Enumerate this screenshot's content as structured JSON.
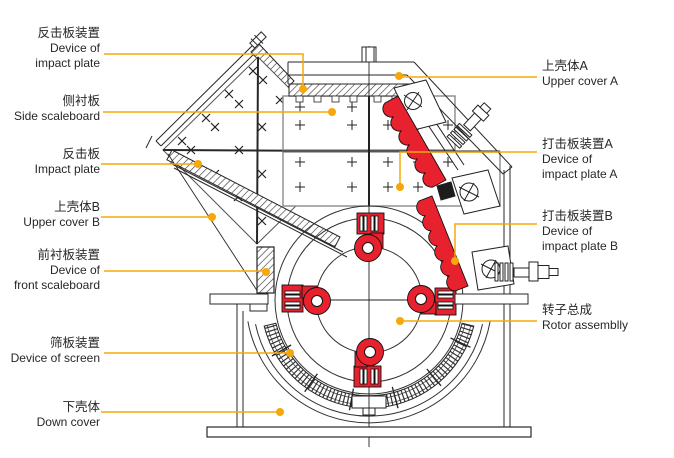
{
  "figure": {
    "kind": "impact-crusher sectional diagram",
    "colors": {
      "accent_leader": "#f6a80a",
      "part_red": "#e8212e",
      "line_ink": "#2a2626"
    }
  },
  "labels_left": [
    {
      "zh": "反击板装置",
      "en_lines": [
        "Device of",
        "impact plate"
      ]
    },
    {
      "zh": "侧衬板",
      "en_lines": [
        "Side scaleboard"
      ]
    },
    {
      "zh": "反击板",
      "en_lines": [
        "Impact plate"
      ]
    },
    {
      "zh": "上壳体B",
      "en_lines": [
        "Upper cover B"
      ]
    },
    {
      "zh": "前衬板装置",
      "en_lines": [
        "Device of",
        "front scaleboard"
      ]
    },
    {
      "zh": "筛板装置",
      "en_lines": [
        "Device of screen"
      ]
    },
    {
      "zh": "下壳体",
      "en_lines": [
        "Down cover"
      ]
    }
  ],
  "labels_right": [
    {
      "zh": "上壳体A",
      "en_lines": [
        "Upper cover A"
      ]
    },
    {
      "zh": "打击板装置A",
      "en_lines": [
        "Device of",
        "impact plate A"
      ]
    },
    {
      "zh": "打击板装置B",
      "en_lines": [
        "Device of",
        "impact plate B"
      ]
    },
    {
      "zh": "转子总成",
      "en_lines": [
        "Rotor assemblly"
      ]
    }
  ]
}
